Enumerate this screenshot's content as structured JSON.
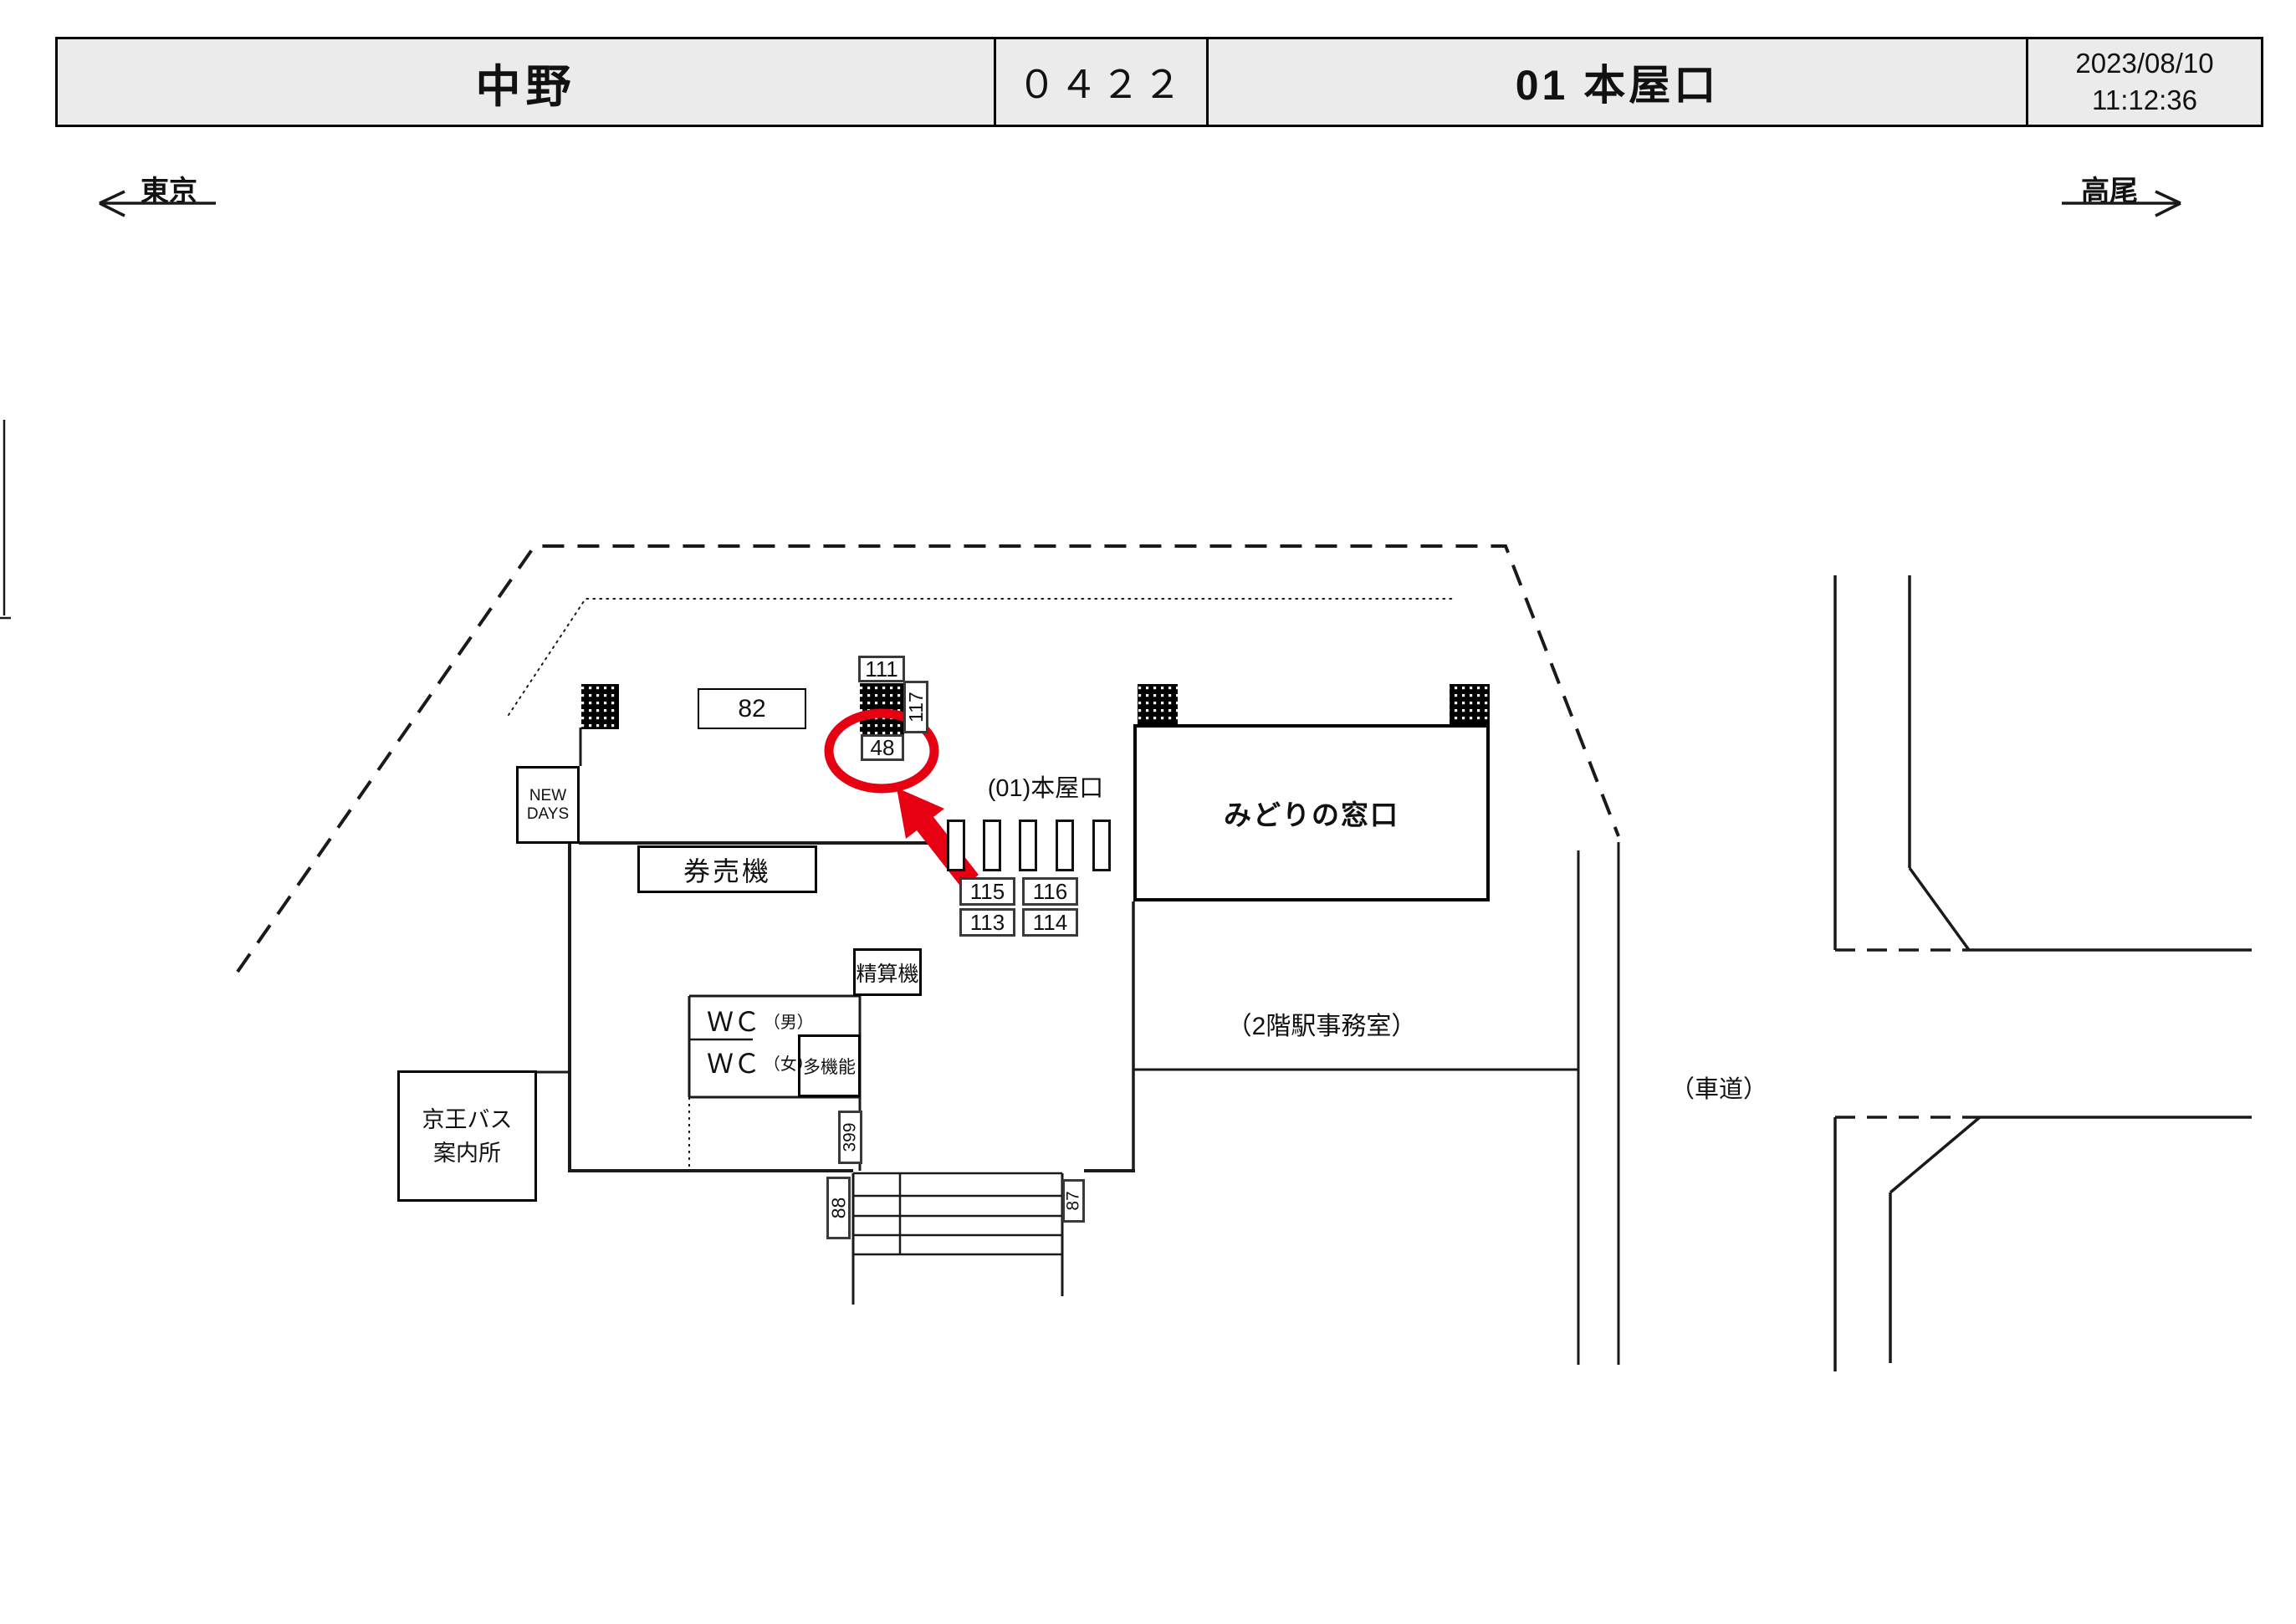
{
  "header": {
    "station": "中野",
    "code": "０４２２",
    "entrance": "01 本屋口",
    "date": "2023/08/10",
    "time": "11:12:36"
  },
  "directions": {
    "left": "東京",
    "right": "高尾"
  },
  "labels": {
    "gate_name": "(01)本屋口",
    "midori_window": "みどりの窓口",
    "ticket_machines": "券売機",
    "fare_adjustment": "精算機",
    "new_days_1": "NEW",
    "new_days_2": "DAYS",
    "wc": "ＷＣ",
    "wc_men_sub": "（男）",
    "wc_women_sub": "（女）",
    "multifunction": "多機能",
    "keio_bus_1": "京王バス",
    "keio_bus_2": "案内所",
    "station_office": "（2階駅事務室）",
    "roadway": "（車道）"
  },
  "cameras": {
    "c82": "82",
    "c111": "111",
    "c117": "117",
    "c48": "48",
    "c115": "115",
    "c116": "116",
    "c113": "113",
    "c114": "114",
    "c399": "399",
    "c88": "88",
    "c87": "87"
  },
  "highlight": {
    "selected_camera": "48",
    "color": "#e60012"
  }
}
